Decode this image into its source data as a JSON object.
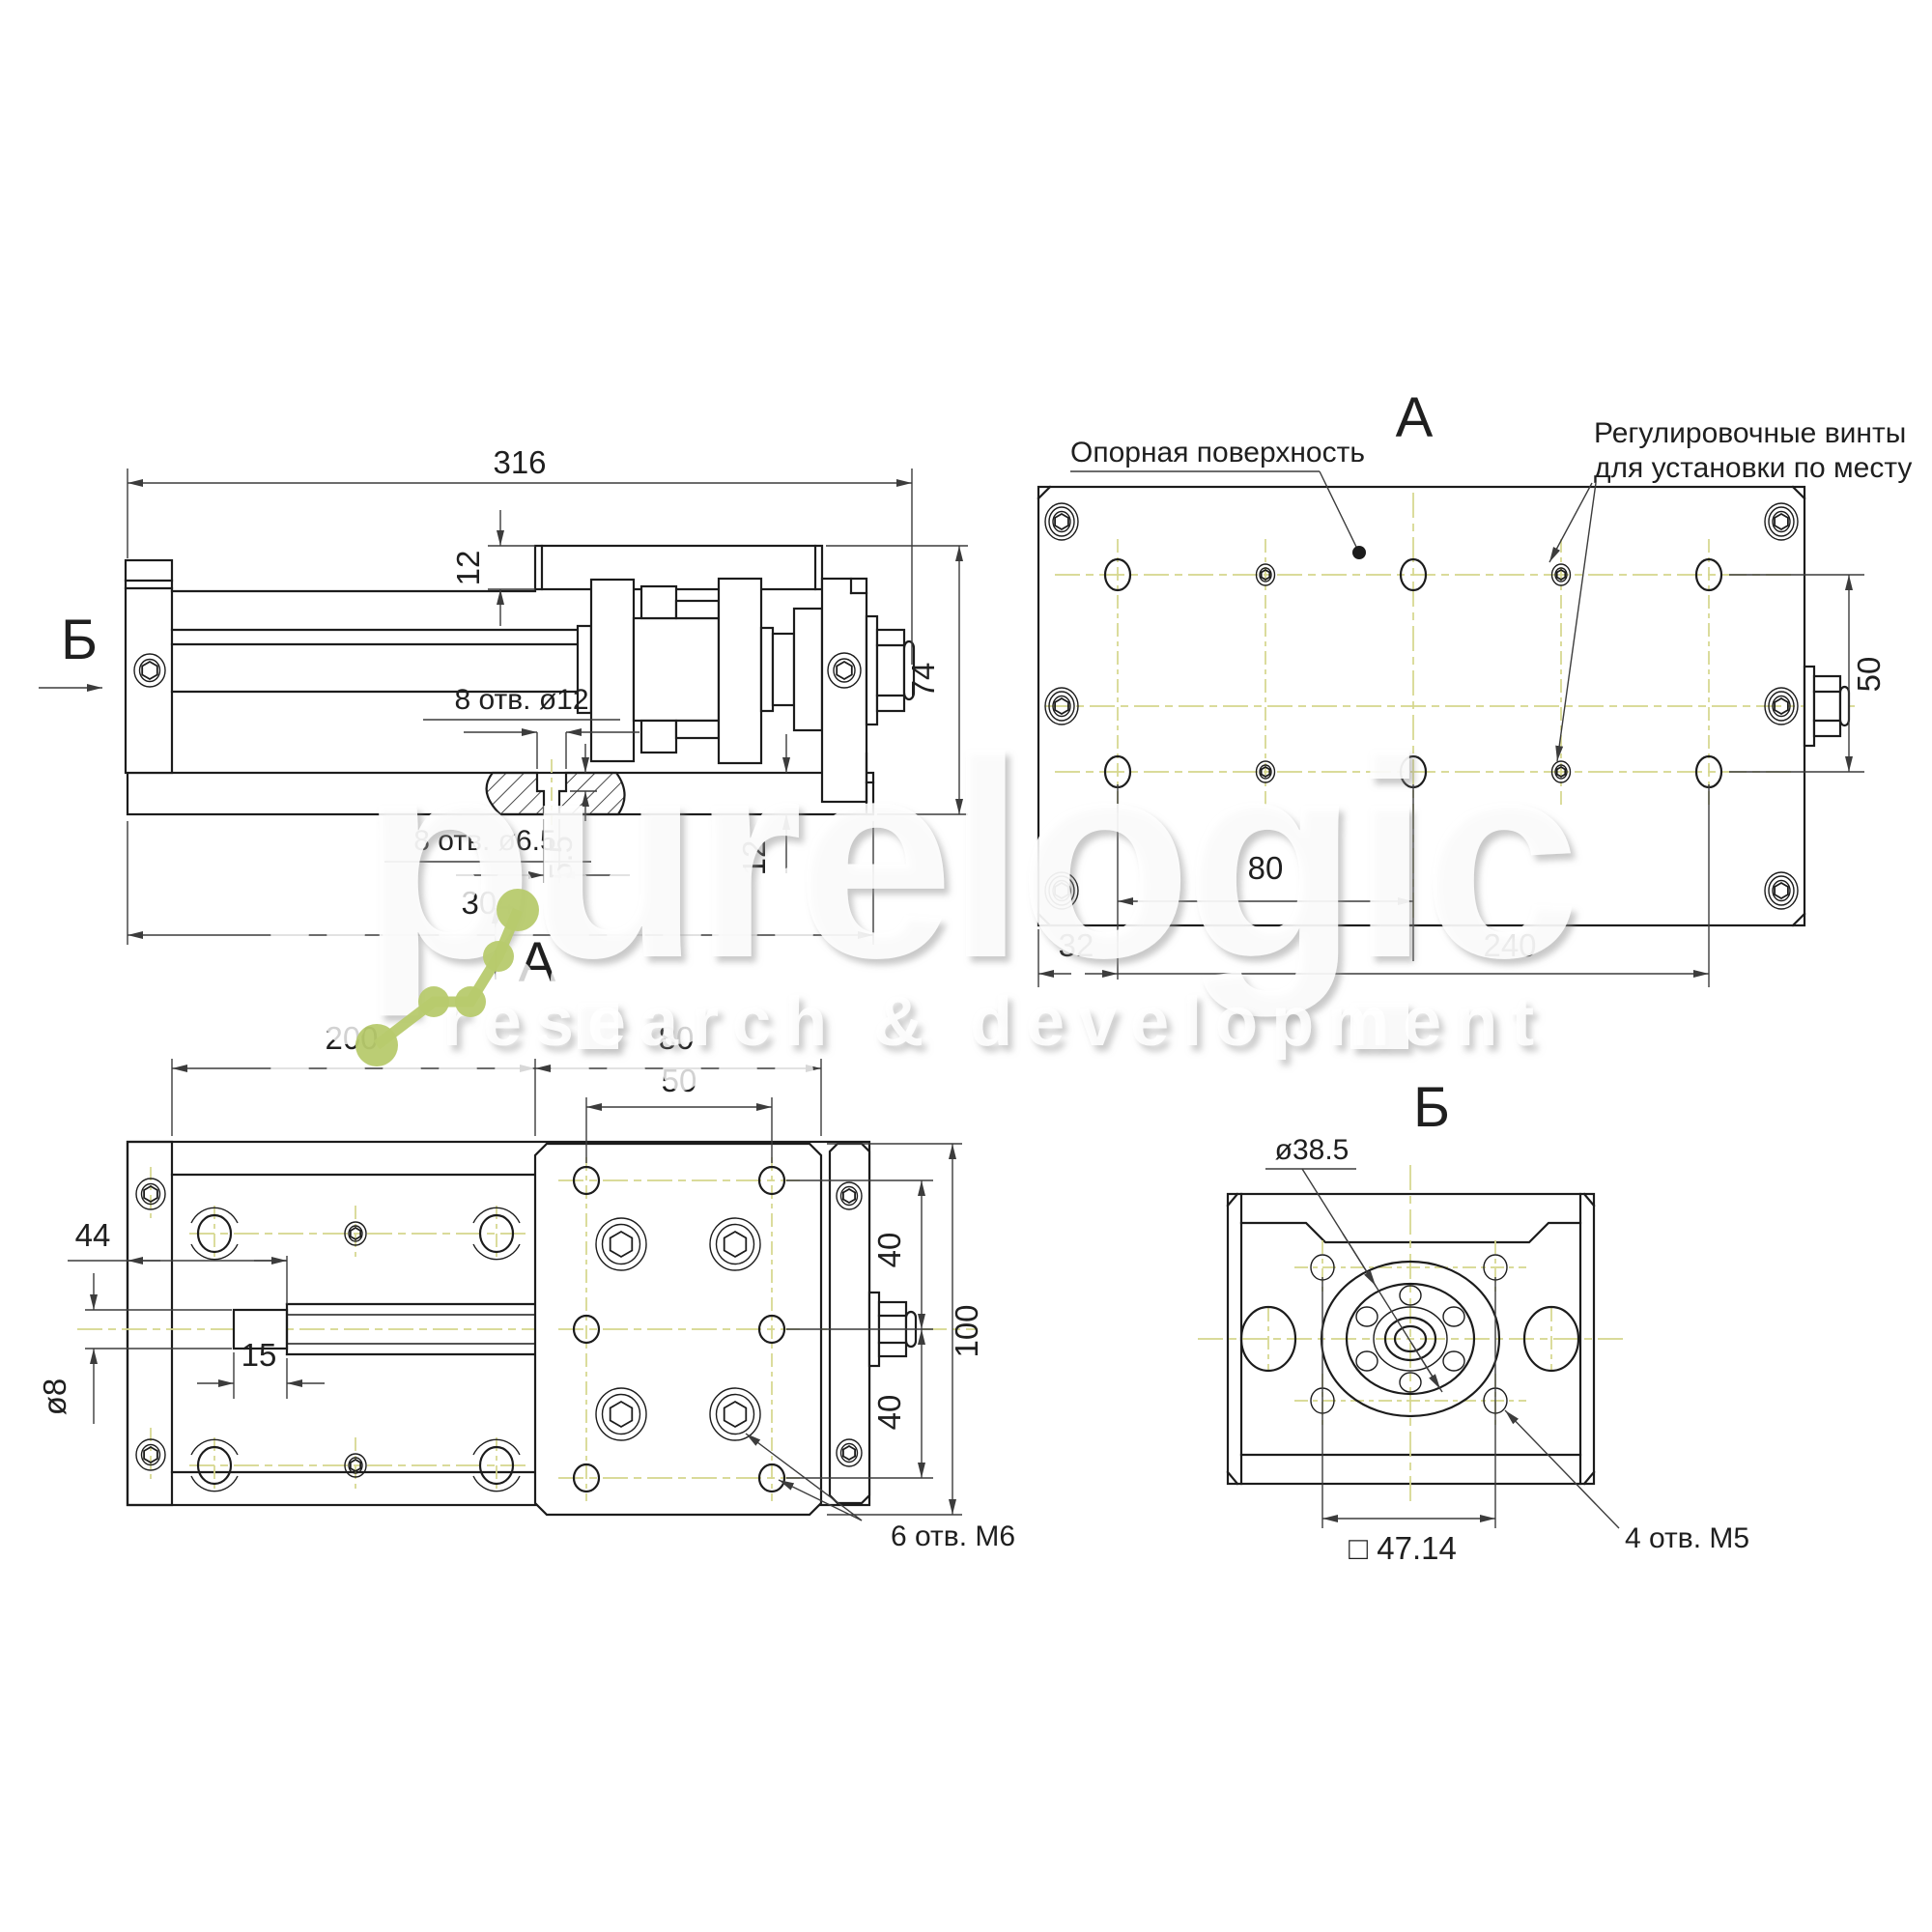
{
  "drawing": {
    "brand": {
      "name": "purelogic",
      "tagline": "research & development"
    },
    "colors": {
      "line": "#1c1c1c",
      "centerline": "#d5d68c",
      "accent_green": "#b7ca6d"
    },
    "views": {
      "side": {
        "dim_total_length": "316",
        "dim_plate_thickness": "12",
        "dim_height": "74",
        "label_holes_counterbore": "8 отв. ø12",
        "label_holes_through": "8 отв. ø6.5",
        "dim_counterbore_depth": "5.5",
        "dim_base_thickness": "12",
        "dim_base_length": "304",
        "view_arrow_b": "Б",
        "view_arrow_a": "А"
      },
      "bottom_a": {
        "title": "А",
        "label_surface": "Опорная поверхность",
        "label_screws_line1": "Регулировочные винты",
        "label_screws_line2": "для установки по месту",
        "dim_hole_pitch": "80",
        "dim_edge_offset": "32",
        "dim_span": "240",
        "dim_row_spacing": "50"
      },
      "plan": {
        "dim_left_length": "200",
        "dim_carriage_length": "80",
        "dim_hole_pitch": "50",
        "dim_shaft_position": "44",
        "dim_shaft_tip_length": "15",
        "dim_shaft_diameter": "ø8",
        "dim_row_top": "40",
        "dim_row_bottom": "40",
        "dim_carriage_width": "100",
        "label_holes_m6": "6 отв. М6"
      },
      "end_b": {
        "title": "Б",
        "dim_flange_diameter": "ø38.5",
        "dim_square_pattern": "□ 47.14",
        "label_holes_m5": "4 отв. М5"
      }
    }
  }
}
